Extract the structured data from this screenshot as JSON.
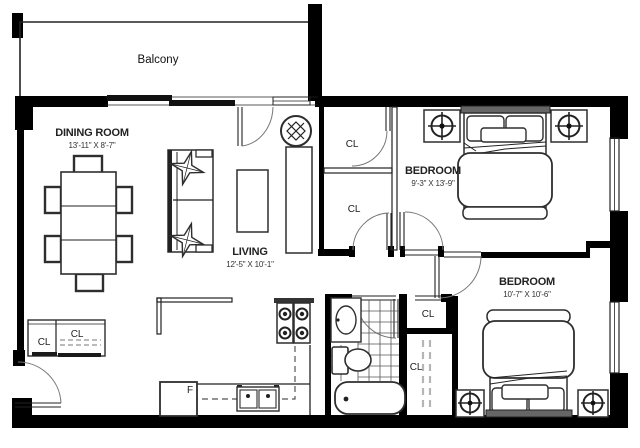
{
  "floorplan": {
    "balcony": {
      "label": "Balcony"
    },
    "dining": {
      "name": "DINING ROOM",
      "dims": "13'-11\" X 8'-7\""
    },
    "living": {
      "name": "LIVING",
      "dims": "12'-5\" X 10'-1\""
    },
    "bedroom1": {
      "name": "BEDROOM",
      "dims": "9'-3\" X 13'-9\""
    },
    "bedroom2": {
      "name": "BEDROOM",
      "dims": "10'-7\" X 10'-6\""
    },
    "closets": {
      "hall_upper": "CL",
      "hall_lower": "CL",
      "entry_left": "CL",
      "entry_right": "CL",
      "bath": "CL",
      "linen": "CL"
    },
    "kitchen": {
      "fridge_label": "F"
    },
    "icons": {
      "ceiling_light": "circle-x-light-symbol",
      "nightstand_lamp": "circle-cross-lamp-symbol"
    },
    "colors": {
      "wall": "#000000",
      "line": "#2e2e2e",
      "text": "#1a1a1a",
      "background": "#ffffff"
    }
  }
}
